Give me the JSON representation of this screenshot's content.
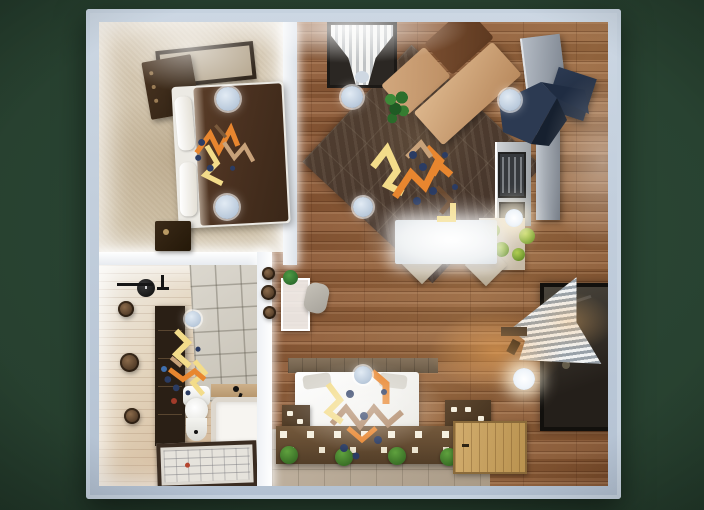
{
  "scene": {
    "type": "3d-floorplan-top-view",
    "label": "Studio apartment 3D floor plan, top-down render",
    "background": "#27402f"
  },
  "palette": {
    "outer_wall": "#b6c4d5",
    "inner_wall": "#f2f4f7",
    "wood_floor": "#96663f",
    "carpet": "#cfc1ab",
    "bath_floor": "#d9c2a4",
    "tile_wall": "#d3cfc6",
    "stone_floor": "#b5a795",
    "living_rug": "#4e3c2f",
    "sofa_tan": "#c89b72",
    "sofa_brown": "#6b4228",
    "kitchen_steel": "#a9b0b8",
    "range_hood_navy": "#2c3a52",
    "bed_duvet_brown": "#4e3523",
    "bed2_white": "#f2f1ed",
    "shelf_brown": "#62492f",
    "door_wood": "#c9a468",
    "plant_green": "#2f7a33",
    "decor_orange": "#e8862f",
    "decor_yellow": "#f3dc8a",
    "decor_tan": "#c8a27a",
    "decor_dot_navy": "#2b3c63",
    "light_fixture": "#c5d3e2",
    "light_lit": "#f5f8fb"
  },
  "rooms": {
    "bedroom": {
      "label": "Bedroom",
      "objects": [
        "bed",
        "dresser",
        "nightstand",
        "wall-art",
        "ceiling-lights",
        "decor-zigzag"
      ]
    },
    "bathroom": {
      "label": "Bathroom",
      "objects": [
        "toilet",
        "bathtub",
        "shelf-unit",
        "wall-clock",
        "towel-bar",
        "floor-mat",
        "wall-plates",
        "decor-zigzag"
      ]
    },
    "living_kitchen": {
      "label": "Living room / Kitchen",
      "objects": [
        "sofa",
        "rug",
        "window-curtain",
        "plant",
        "fridge",
        "range-hood",
        "oven",
        "counter",
        "tall-cabinet",
        "dining-table",
        "chairs",
        "decor-zigzag"
      ]
    },
    "bedroom2": {
      "label": "Second bedroom",
      "objects": [
        "bed",
        "headboard",
        "storage-shelf",
        "candles",
        "plants",
        "decor-zigzag"
      ]
    },
    "entry": {
      "label": "Entry",
      "objects": [
        "door",
        "window-curtain",
        "wall-shelf",
        "wall-lamp"
      ]
    }
  },
  "lights": {
    "ceiling_light_count": 9,
    "lit_count": 2
  }
}
